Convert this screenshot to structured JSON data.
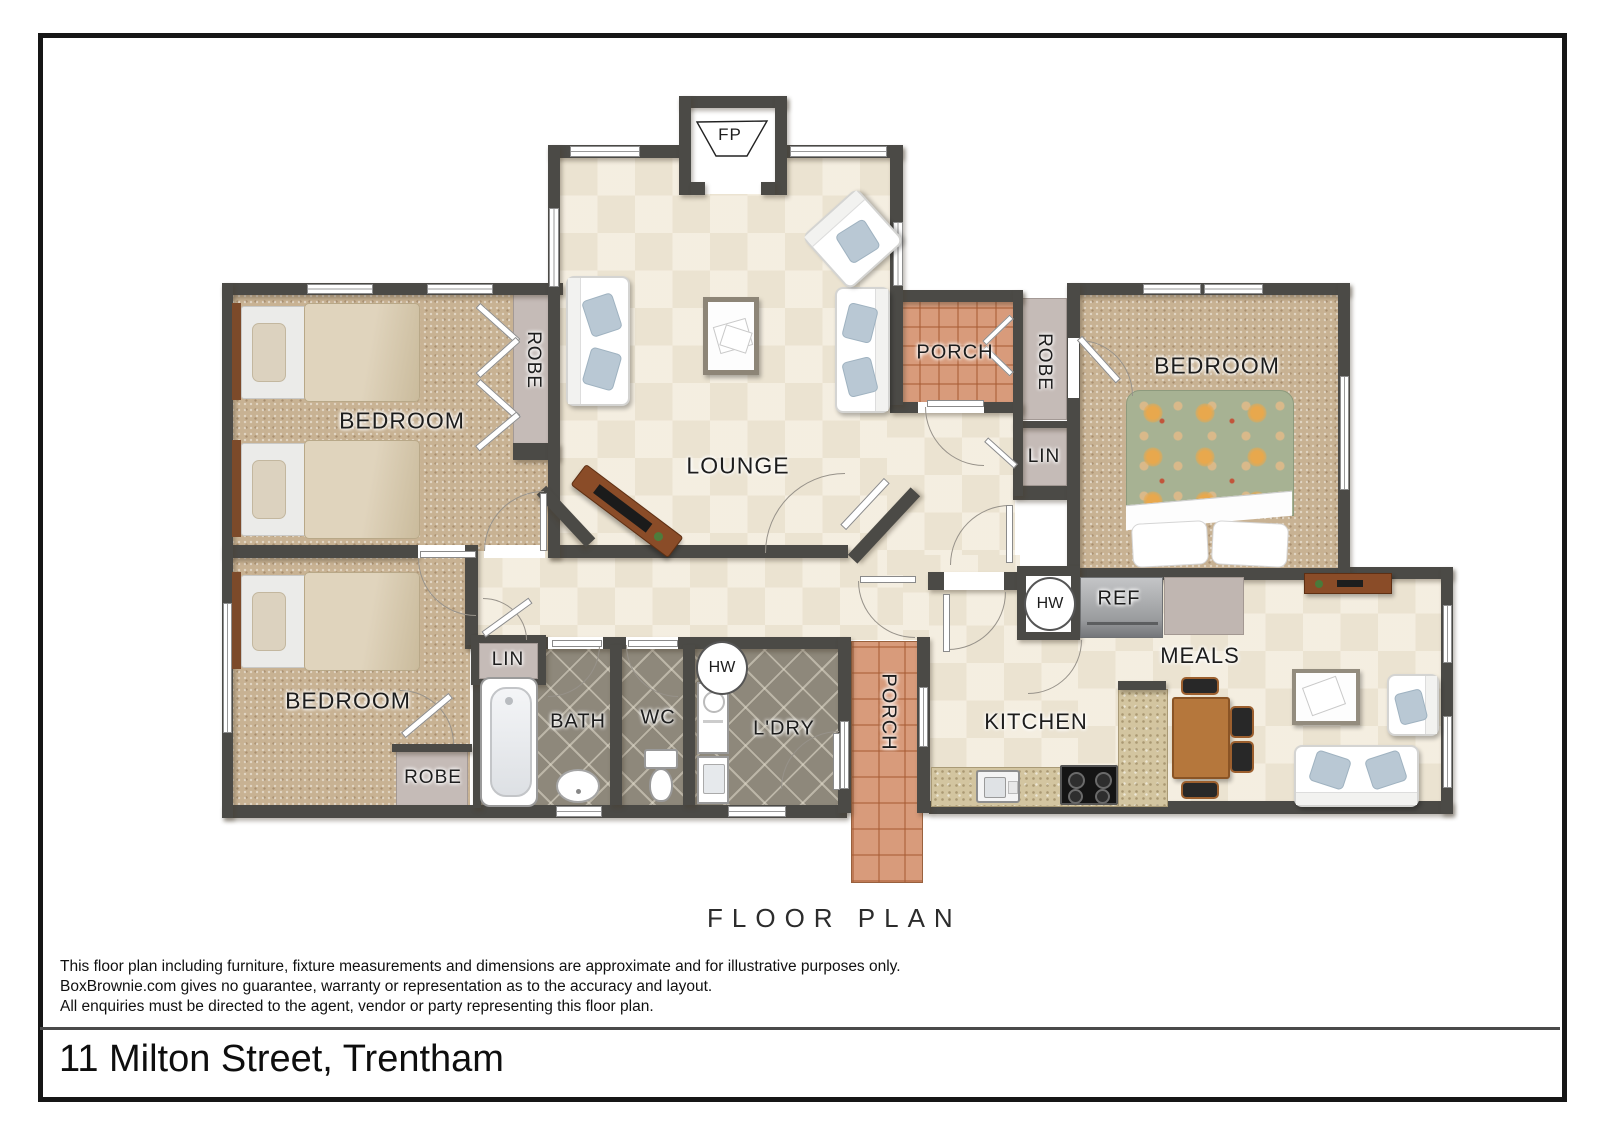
{
  "title_block": {
    "floor_plan_label": "FLOOR PLAN",
    "address": "11 Milton Street, Trentham",
    "disclaimer_lines": [
      "This floor plan including furniture, fixture measurements and dimensions are approximate and for illustrative purposes only.",
      "BoxBrownie.com gives no guarantee, warranty or representation as to the accuracy and layout.",
      "All enquiries must be directed to the agent, vendor or party representing this floor plan."
    ]
  },
  "room_labels": {
    "bedroom_top_left": "BEDROOM",
    "bedroom_bottom_left": "BEDROOM",
    "bedroom_right": "BEDROOM",
    "lounge": "LOUNGE",
    "meals": "MEALS",
    "kitchen": "KITCHEN",
    "bath": "BATH",
    "wc": "WC",
    "laundry": "L'DRY",
    "porch_top": "PORCH",
    "porch_bottom": "PORCH",
    "robe_top_left": "ROBE",
    "robe_bottom_left": "ROBE",
    "robe_right": "ROBE",
    "linen_hall": "LIN",
    "linen_right": "LIN",
    "hot_water_laundry": "HW",
    "hot_water_kitchen": "HW",
    "fridge": "REF",
    "fireplace": "FP"
  },
  "colors": {
    "wall": "#4b4a46",
    "floor_tile": "#ebe3d1",
    "bedroom_carpet": "#c8b293",
    "wet_area_tile": "#8e887b",
    "porch_tile": "#d89b7b",
    "bench_granite": "#d3c5a0",
    "timber": "#8a4c28"
  }
}
